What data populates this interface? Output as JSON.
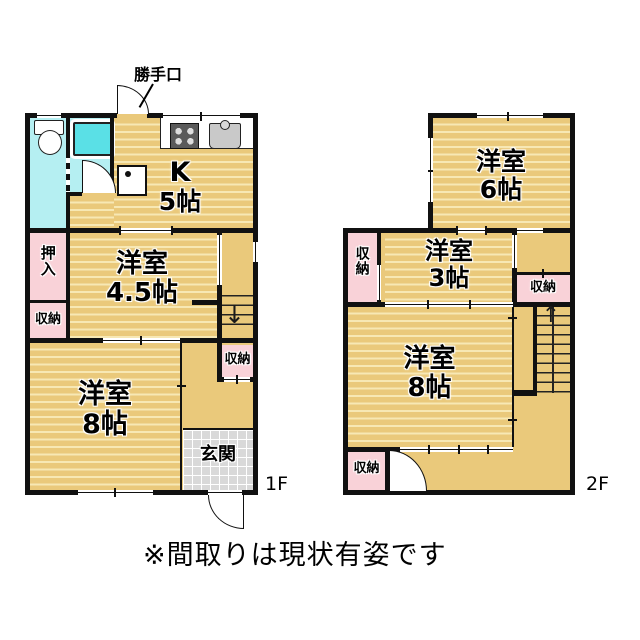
{
  "footnote": "※間取りは現状有姿です",
  "floor1": {
    "label": "1F",
    "back_door_label": "勝手口",
    "kitchen": {
      "name": "K",
      "size": "5帖"
    },
    "room45": {
      "name": "洋室",
      "size": "4.5帖"
    },
    "room8": {
      "name": "洋室",
      "size": "8帖"
    },
    "oshiire": "押入",
    "closet_left": "収納",
    "closet_hall": "収納",
    "entrance": "玄関",
    "stairs_down_arrow": "↓"
  },
  "floor2": {
    "label": "2F",
    "room6": {
      "name": "洋室",
      "size": "6帖"
    },
    "room3": {
      "name": "洋室",
      "size": "3帖"
    },
    "room8": {
      "name": "洋室",
      "size": "8帖"
    },
    "closet_left": "収納",
    "closet_right": "収納",
    "closet_bottom": "収納",
    "stairs_up_arrow": "↑"
  },
  "colors": {
    "floor": "#eac97b",
    "floor_stripe": "#f7e8b4",
    "closet": "#f9d2d8",
    "wet_area": "#b5eff2",
    "bathtub": "#5ae0e6",
    "entrance_tile": "#d9d9d9",
    "wall": "#111111"
  }
}
